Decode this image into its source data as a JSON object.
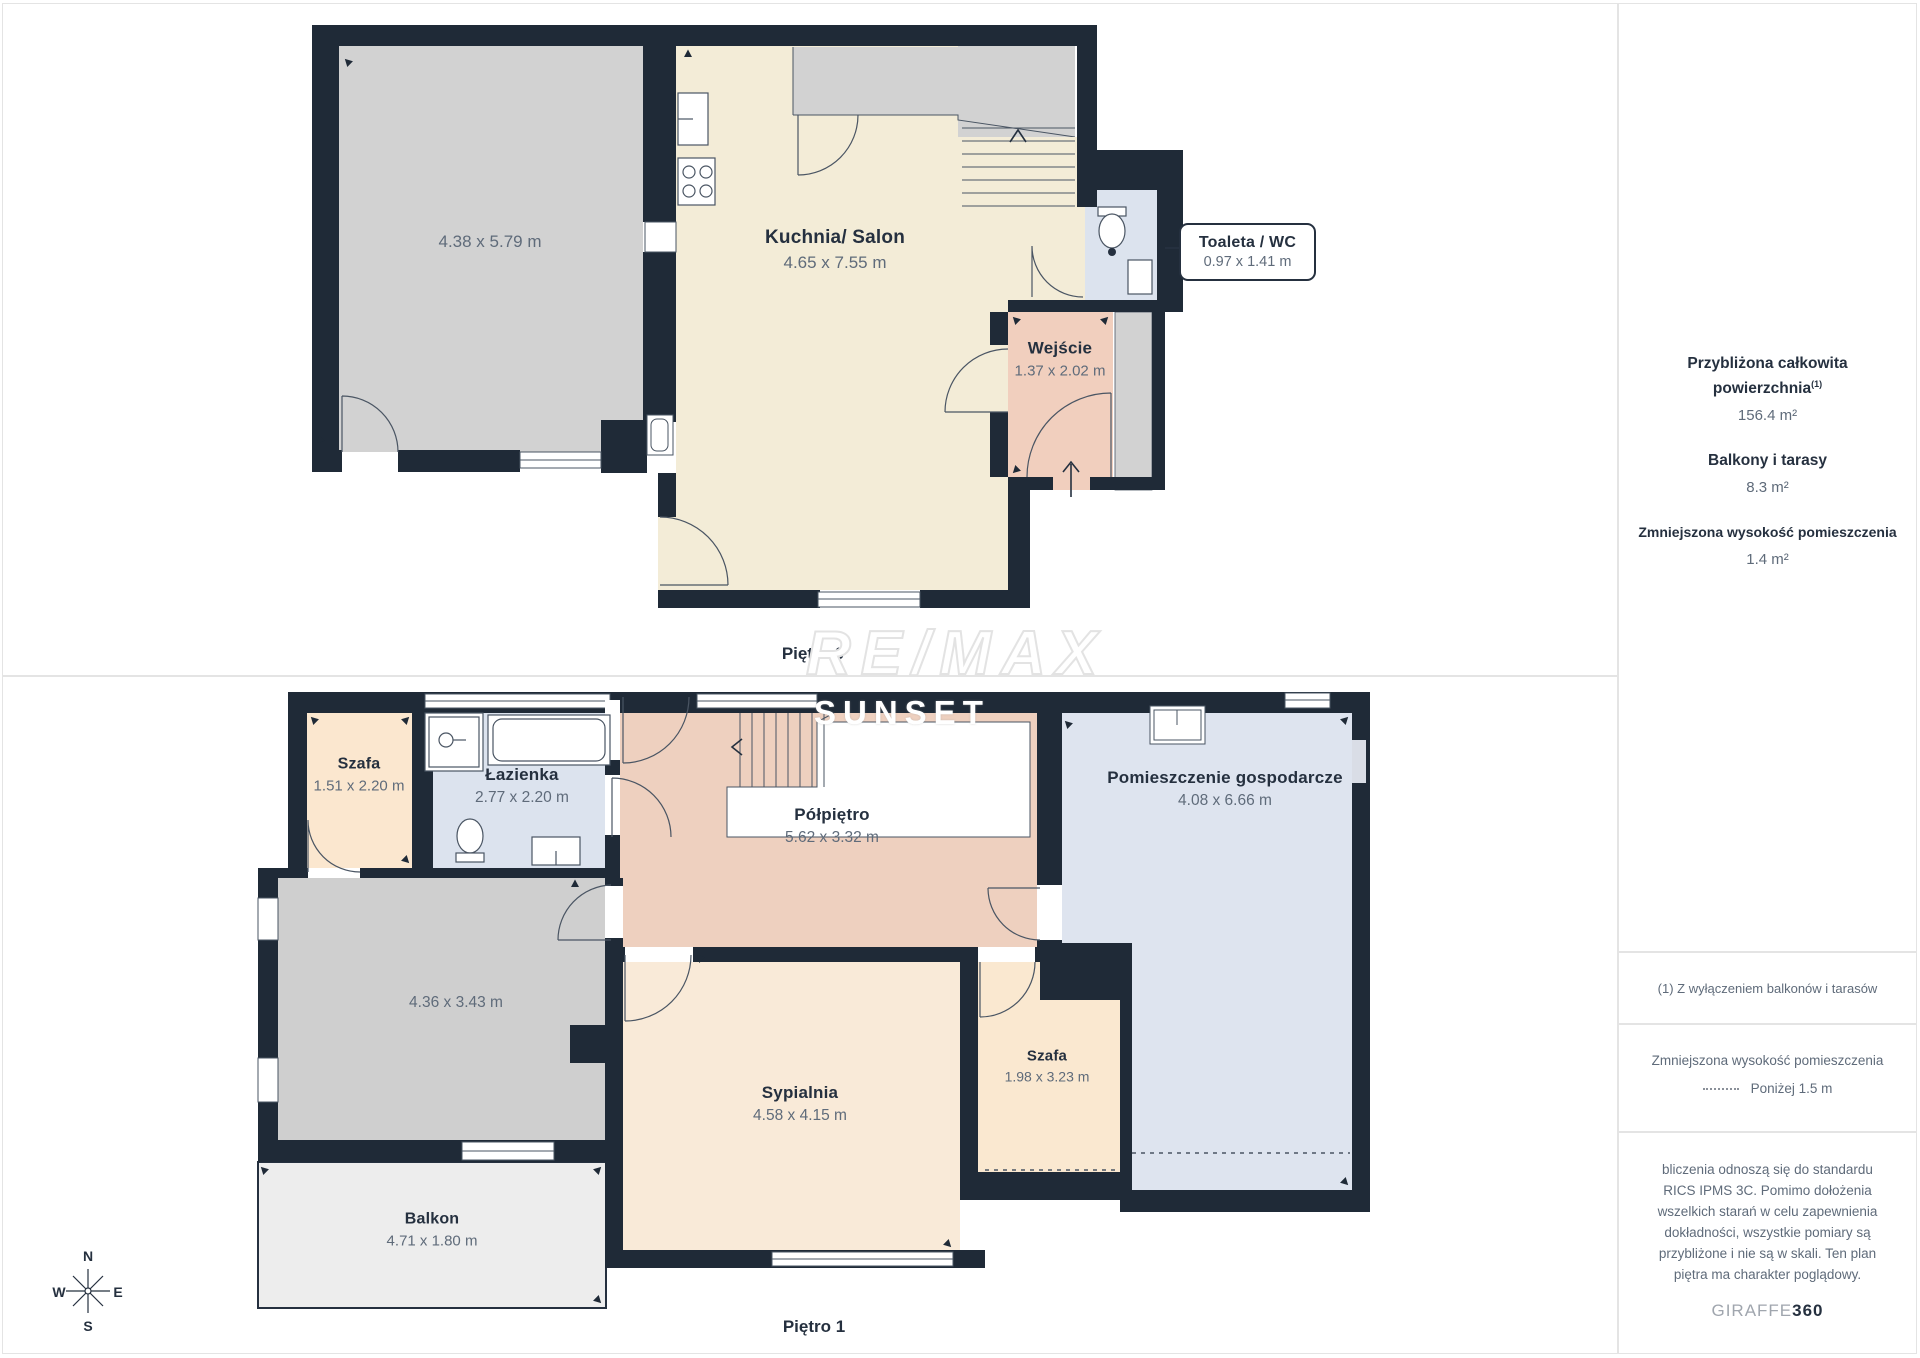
{
  "floor0": {
    "title": "Piętro 0",
    "rooms": {
      "room": {
        "dims": "4.38 x 5.79 m"
      },
      "kitchen": {
        "name": "Kuchnia/ Salon",
        "dims": "4.65 x 7.55 m"
      },
      "entry": {
        "name": "Wejście",
        "dims": "1.37 x 2.02 m"
      },
      "wc": {
        "name": "Toaleta / WC",
        "dims": "0.97 x 1.41 m"
      }
    }
  },
  "floor1": {
    "title": "Piętro 1",
    "rooms": {
      "closet1": {
        "name": "Szafa",
        "dims": "1.51 x 2.20 m"
      },
      "bathroom": {
        "name": "Łazienka",
        "dims": "2.77 x 2.20 m"
      },
      "landing": {
        "name": "Półpiętro",
        "dims": "5.62 x 3.32 m"
      },
      "utility": {
        "name": "Pomieszczenie gospodarcze",
        "dims": "4.08 x 6.66 m"
      },
      "grayroom": {
        "dims": "4.36 x 3.43 m"
      },
      "bedroom": {
        "name": "Sypialnia",
        "dims": "4.58 x 4.15 m"
      },
      "closet2": {
        "name": "Szafa",
        "dims": "1.98 x 3.23 m"
      },
      "balcony": {
        "name": "Balkon",
        "dims": "4.71 x 1.80 m"
      }
    }
  },
  "sidebar": {
    "area": {
      "heading": "Przybliżona całkowita\npowierzchnia",
      "heading_sup": "(1)",
      "value": "156.4 m²",
      "balconies_heading": "Balkony i tarasy",
      "balconies_value": "8.3 m²",
      "reduced_heading": "Zmniejszona wysokość pomieszczenia",
      "reduced_value": "1.4 m²"
    },
    "note": "(1) Z wyłączeniem balkonów i tarasów",
    "legend": {
      "heading": "Zmniejszona wysokość pomieszczenia",
      "value": "Poniżej 1.5 m"
    },
    "disclaimer": "bliczenia odnoszą się do standardu\nRICS IPMS 3C. Pomimo dołożenia\nwszelkich starań w celu zapewnienia\ndokładności, wszystkie pomiary są\nprzybliżone i nie są w skali. Ten plan\npiętra ma charakter poglądowy.",
    "brand": {
      "name": "GIRAFFE",
      "number": "360"
    }
  },
  "watermark": {
    "line1": "RE/MAX",
    "line2": "SUNSET"
  },
  "compass": {
    "n": "N",
    "w": "W",
    "e": "E",
    "s": "S"
  },
  "colors": {
    "wall": "#1f2a37",
    "gray0": "#d2d2d2",
    "gray1": "#cfcfcf",
    "kitchen": "#f3ecd7",
    "blue": "#dce3ee",
    "blue2": "#dee4ef",
    "salmon": "#f1cfbe",
    "salmon2": "#eed0bf",
    "cream1": "#fbe7cf",
    "cream2": "#f9ead8",
    "cream3": "#fae8d0",
    "balcony": "#ededed",
    "line": "#4a5563",
    "niche": "#d9dde6"
  }
}
